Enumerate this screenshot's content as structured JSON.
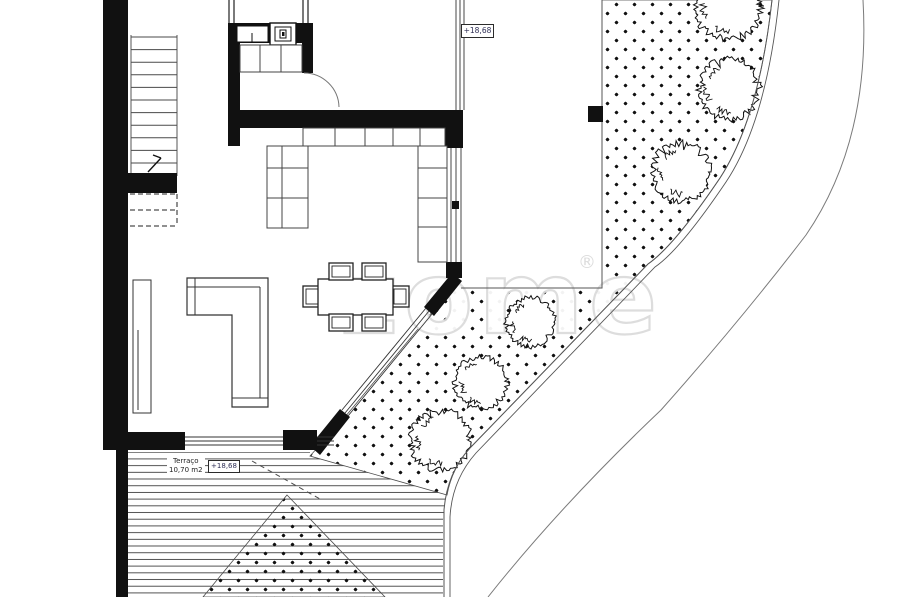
{
  "plan": {
    "watermark": "zome",
    "watermark_reg": "®",
    "labels": {
      "upper_level_marker": "+18,68",
      "terrace_name": "Terraço",
      "terrace_area": "10,70 m2",
      "terrace_level_marker": "+18,68"
    },
    "colors": {
      "wall": "#111111",
      "thin_line": "#444444",
      "hatch_line": "#3f3f3f",
      "road_line": "#7a7a7a",
      "marker_text": "#2e2e55",
      "watermark": "#dcdcdc",
      "background": "#ffffff"
    }
  }
}
